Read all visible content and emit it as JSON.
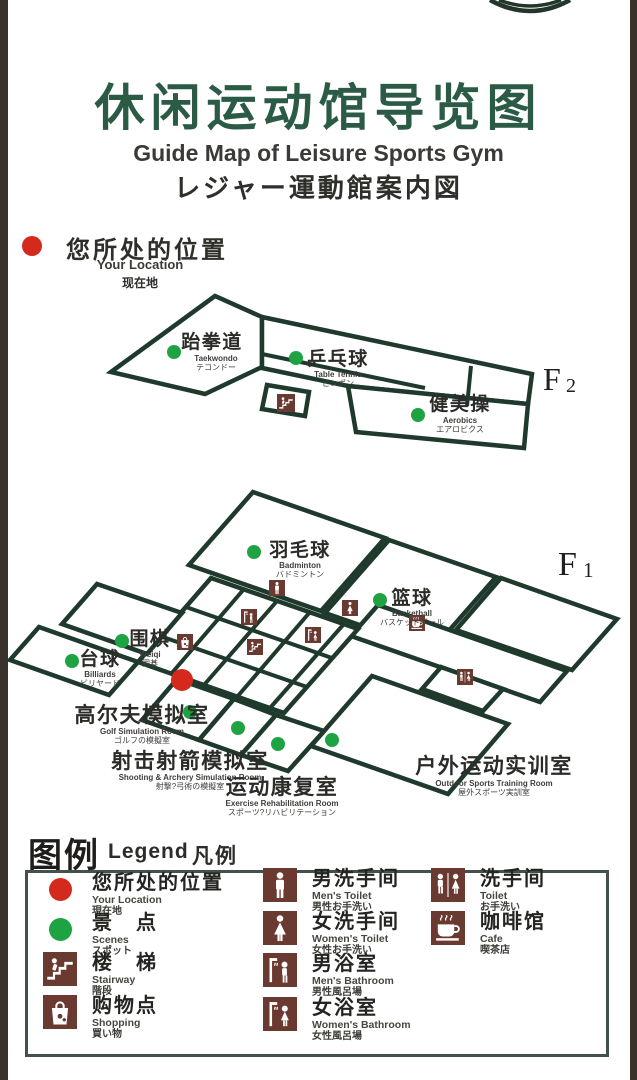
{
  "colors": {
    "title_green": "#2b5a45",
    "map_line": "#1f3a2d",
    "accent_red": "#d42a1e",
    "scene_green": "#1ea343",
    "icon_brown": "#6a392f",
    "edge_bar": "#3a312d"
  },
  "header": {
    "title_zh": "休闲运动馆导览图",
    "title_en": "Guide Map of Leisure Sports Gym",
    "title_ja": "レジャー運動館案内図"
  },
  "you_are_here": {
    "zh": "您所处的位置",
    "en": "Your Location",
    "ja": "现在地"
  },
  "floors": [
    {
      "name": "F2",
      "prefix": "F",
      "number": "2",
      "rooms": [
        {
          "zh": "跆拳道",
          "en": "Taekwondo",
          "ja": "テコンドー"
        },
        {
          "zh": "乒乓球",
          "en": "Table Tennis",
          "ja": "ピンポン"
        },
        {
          "zh": "健美操",
          "en": "Aerobics",
          "ja": "エアロビクス"
        }
      ]
    },
    {
      "name": "F1",
      "prefix": "F",
      "number": "1",
      "rooms": [
        {
          "zh": "羽毛球",
          "en": "Badminton",
          "ja": "バドミントン"
        },
        {
          "zh": "篮球",
          "en": "Basketball",
          "ja": "バスケットボール"
        },
        {
          "zh": "围棋",
          "en": "Weiqi",
          "ja": "囲碁"
        },
        {
          "zh": "台球",
          "en": "Billiards",
          "ja": "ビリヤード"
        },
        {
          "zh": "高尔夫模拟室",
          "en": "Golf Simulation Room",
          "ja": "ゴルフの模擬室"
        },
        {
          "zh": "射击射箭模拟室",
          "en": "Shooting & Archery Simulation Room",
          "ja": "射撃?弓術の模擬室"
        },
        {
          "zh": "运动康复室",
          "en": "Exercise Rehabilitation Room",
          "ja": "スポーツ?リハビリテーション"
        },
        {
          "zh": "户外运动实训室",
          "en": "Outdoor Sports Training Room",
          "ja": "屋外スポーツ実訓室"
        }
      ]
    }
  ],
  "legend": {
    "title_zh": "图例",
    "title_en": "Legend",
    "title_ja": "凡例",
    "items": [
      {
        "icon": "location-dot",
        "zh": "您所处的位置",
        "en": "Your Location",
        "ja": "現在地"
      },
      {
        "icon": "scene-dot",
        "zh": "景　点",
        "en": "Scenes",
        "ja": "スポット"
      },
      {
        "icon": "stairway",
        "zh": "楼　梯",
        "en": "Stairway",
        "ja": "階段"
      },
      {
        "icon": "shopping",
        "zh": "购物点",
        "en": "Shopping",
        "ja": "買い物"
      },
      {
        "icon": "mens-toilet",
        "zh": "男洗手间",
        "en": "Men's Toilet",
        "ja": "男性お手洗い"
      },
      {
        "icon": "womens-toilet",
        "zh": "女洗手间",
        "en": "Women's Toilet",
        "ja": "女性お手洗い"
      },
      {
        "icon": "mens-bathroom",
        "zh": "男浴室",
        "en": "Men's Bathroom",
        "ja": "男性風呂場"
      },
      {
        "icon": "womens-bathroom",
        "zh": "女浴室",
        "en": "Women's Bathroom",
        "ja": "女性風呂場"
      },
      {
        "icon": "toilet",
        "zh": "洗手间",
        "en": "Toilet",
        "ja": "お手洗い"
      },
      {
        "icon": "cafe",
        "zh": "咖啡馆",
        "en": "Cafe",
        "ja": "喫茶店"
      }
    ]
  }
}
